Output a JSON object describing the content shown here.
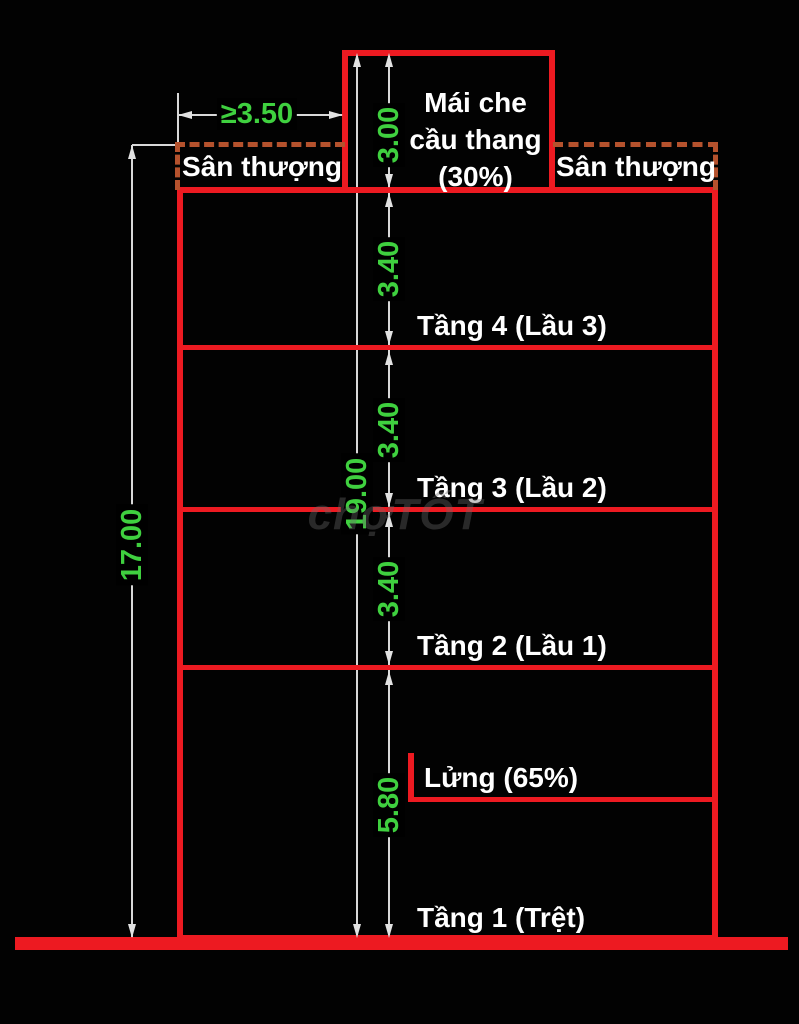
{
  "drawing": {
    "title_none": "",
    "stair_roof": {
      "line1": "Mái che",
      "line2": "cầu thang",
      "line3": "(30%)"
    },
    "terrace_left": "Sân thượng",
    "terrace_right": "Sân thượng",
    "floor_labels": {
      "f4": "Tầng 4 (Lầu 3)",
      "f3": "Tầng 3 (Lầu 2)",
      "f2": "Tầng 2 (Lầu 1)",
      "mezzanine": "Lửng (65%)",
      "f1": "Tầng 1 (Trệt)"
    },
    "dimensions": {
      "roof_min_width": "≥3.50",
      "stair_roof_height": "3.00",
      "floor4_height": "3.40",
      "floor3_height": "3.40",
      "floor2_height": "3.40",
      "ground_floor_height": "5.80",
      "total_with_roof": "19.00",
      "total_to_terrace": "17.00"
    },
    "watermark": "chợTỐT",
    "colors": {
      "background": "#020202",
      "wall_red": "#ed1a21",
      "terrace_dashed_orange": "#b5522d",
      "dimension_green": "#3fd03f",
      "dim_line_gray": "#d8d8d8",
      "label_white": "#ffffff",
      "watermark_gray": "#696969"
    }
  }
}
